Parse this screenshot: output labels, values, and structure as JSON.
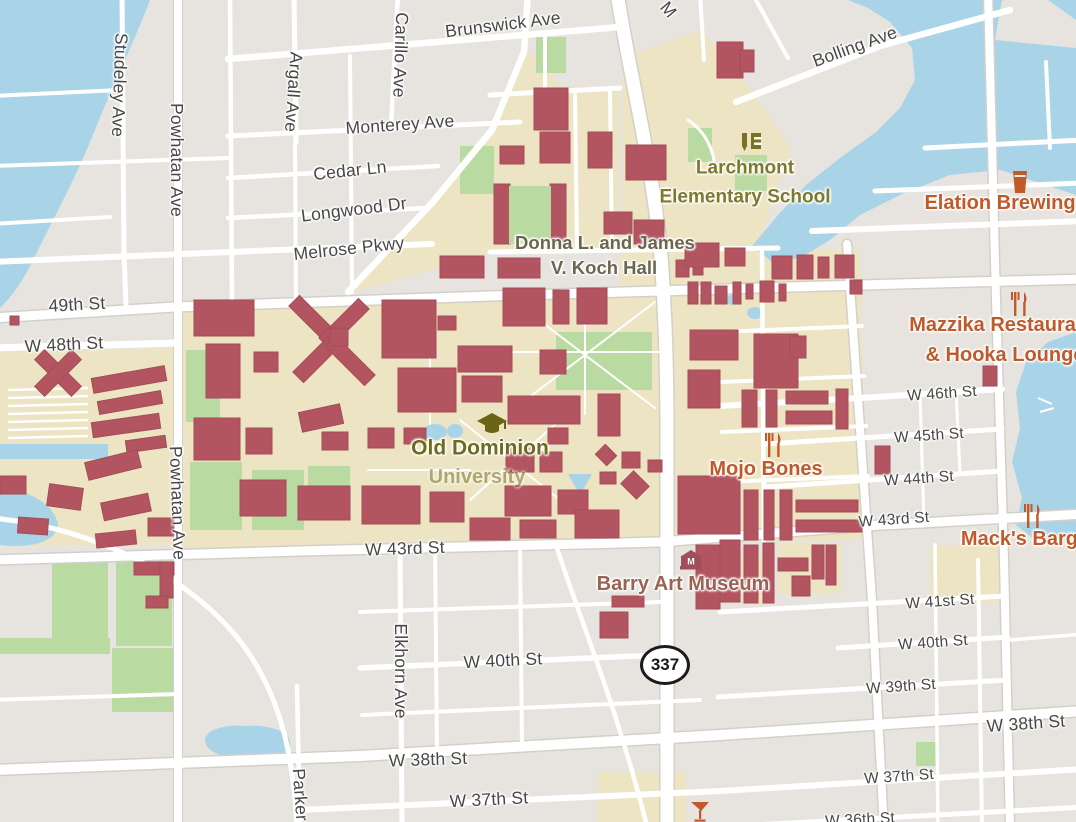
{
  "map": {
    "route_shield": {
      "number": "337"
    },
    "colors": {
      "land": "#e7e4df",
      "water": "#a9d4e8",
      "campus": "#ece4c3",
      "green": "#b9dba2",
      "bld": "#b35561",
      "blds": "#a34c57",
      "road": "#ffffff",
      "casing": "#d4d0c9",
      "street": "#474747",
      "orange": "#c05a2a",
      "olive": "#7c7a2c",
      "campusTxt": "#6f6b1d",
      "kochTxt": "#6b674f",
      "museumTxt": "#9a6254"
    },
    "street_labels": [
      {
        "name": "street-label-brunswick-ave",
        "text": "Brunswick Ave",
        "x": 503,
        "y": 25,
        "r": -7,
        "cls": "lbl-street-major"
      },
      {
        "name": "street-label-bolling-ave",
        "text": "Bolling Ave",
        "x": 855,
        "y": 47,
        "r": -20,
        "cls": "lbl-street-major"
      },
      {
        "name": "street-label-studeley-ave",
        "text": "Studeley Ave",
        "x": 119,
        "y": 85,
        "r": 92,
        "cls": "lbl-street-major"
      },
      {
        "name": "street-label-powhatan-ave-north",
        "text": "Powhatan Ave",
        "x": 176,
        "y": 160,
        "r": 90,
        "cls": "lbl-street-major"
      },
      {
        "name": "street-label-argall-ave",
        "text": "Argall Ave",
        "x": 293,
        "y": 92,
        "r": 94,
        "cls": "lbl-street-major"
      },
      {
        "name": "street-label-carillo-ave",
        "text": "Carillo Ave",
        "x": 400,
        "y": 55,
        "r": 92,
        "cls": "lbl-street-major"
      },
      {
        "name": "street-label-monterey-ave",
        "text": "Monterey Ave",
        "x": 400,
        "y": 125,
        "r": -4,
        "cls": "lbl-street-major"
      },
      {
        "name": "street-label-cedar-ln",
        "text": "Cedar Ln",
        "x": 350,
        "y": 171,
        "r": -6,
        "cls": "lbl-street-major"
      },
      {
        "name": "street-label-longwood-dr",
        "text": "Longwood Dr",
        "x": 354,
        "y": 210,
        "r": -7,
        "cls": "lbl-street-major"
      },
      {
        "name": "street-label-melrose-pkwy",
        "text": "Melrose Pkwy",
        "x": 349,
        "y": 249,
        "r": -6,
        "cls": "lbl-street-major"
      },
      {
        "name": "street-label-fragment-m",
        "text": "M",
        "x": 668,
        "y": 10,
        "r": 50,
        "cls": "lbl-street-major"
      },
      {
        "name": "street-label-49th-st",
        "text": "49th St",
        "x": 77,
        "y": 305,
        "r": -3,
        "cls": "lbl-street-major"
      },
      {
        "name": "street-label-w-48th-st",
        "text": "W 48th St",
        "x": 64,
        "y": 345,
        "r": -3,
        "cls": "lbl-street-major"
      },
      {
        "name": "street-label-powhatan-ave-south",
        "text": "Powhatan Ave",
        "x": 177,
        "y": 503,
        "r": 88,
        "cls": "lbl-street-major"
      },
      {
        "name": "street-label-w-46th-st",
        "text": "W 46th St",
        "x": 942,
        "y": 394,
        "r": -4,
        "cls": "lbl-street"
      },
      {
        "name": "street-label-w-45th-st",
        "text": "W 45th St",
        "x": 929,
        "y": 436,
        "r": -4,
        "cls": "lbl-street"
      },
      {
        "name": "street-label-w-44th-st",
        "text": "W 44th St",
        "x": 919,
        "y": 479,
        "r": -4,
        "cls": "lbl-street"
      },
      {
        "name": "street-label-w-43rd-st-east",
        "text": "W 43rd St",
        "x": 894,
        "y": 520,
        "r": -4,
        "cls": "lbl-street"
      },
      {
        "name": "street-label-w-43rd-st-center",
        "text": "W 43rd St",
        "x": 405,
        "y": 549,
        "r": -2,
        "cls": "lbl-street-major"
      },
      {
        "name": "street-label-w-41st-st",
        "text": "W 41st St",
        "x": 940,
        "y": 602,
        "r": -4,
        "cls": "lbl-street"
      },
      {
        "name": "street-label-w-40th-st-east",
        "text": "W 40th St",
        "x": 933,
        "y": 643,
        "r": -4,
        "cls": "lbl-street"
      },
      {
        "name": "street-label-w-40th-st-center",
        "text": "W 40th St",
        "x": 503,
        "y": 661,
        "r": -3,
        "cls": "lbl-street-major"
      },
      {
        "name": "street-label-w-39th-st",
        "text": "W 39th St",
        "x": 901,
        "y": 687,
        "r": -4,
        "cls": "lbl-street"
      },
      {
        "name": "street-label-w-38th-st-east",
        "text": "W 38th St",
        "x": 1026,
        "y": 724,
        "r": -4,
        "cls": "lbl-street-major"
      },
      {
        "name": "street-label-w-38th-st-center",
        "text": "W 38th St",
        "x": 428,
        "y": 760,
        "r": -2,
        "cls": "lbl-street-major"
      },
      {
        "name": "street-label-w-37th-st-east",
        "text": "W 37th St",
        "x": 899,
        "y": 777,
        "r": -4,
        "cls": "lbl-street"
      },
      {
        "name": "street-label-w-37th-st-center",
        "text": "W 37th St",
        "x": 489,
        "y": 800,
        "r": -3,
        "cls": "lbl-street-major"
      },
      {
        "name": "street-label-w-36th-st",
        "text": "W 36th St",
        "x": 860,
        "y": 820,
        "r": -3,
        "cls": "lbl-street"
      },
      {
        "name": "street-label-elkhorn-ave",
        "text": "Elkhorn Ave",
        "x": 400,
        "y": 671,
        "r": 90,
        "cls": "lbl-street-major"
      },
      {
        "name": "street-label-parker-ave",
        "text": "Parker Ave",
        "x": 301,
        "y": 812,
        "r": 86,
        "cls": "lbl-street-major"
      }
    ],
    "poi_labels": [
      {
        "name": "poi-label-larchmont-line1",
        "text": "Larchmont",
        "x": 745,
        "y": 168,
        "cls": "lbl-poi-olive"
      },
      {
        "name": "poi-label-larchmont-line2",
        "text": "Elementary School",
        "x": 745,
        "y": 197,
        "cls": "lbl-poi-olive"
      },
      {
        "name": "poi-label-elation-brewing",
        "text": "Elation Brewing",
        "x": 1000,
        "y": 203,
        "cls": "lbl-poi-orange"
      },
      {
        "name": "poi-label-mazzika-line1",
        "text": "Mazzika Restaurant",
        "x": 1002,
        "y": 325,
        "cls": "lbl-poi-orange"
      },
      {
        "name": "poi-label-mazzika-line2",
        "text": "& Hooka Lounge",
        "x": 1005,
        "y": 355,
        "cls": "lbl-poi-orange"
      },
      {
        "name": "poi-label-mojo-bones",
        "text": "Mojo Bones",
        "x": 766,
        "y": 469,
        "cls": "lbl-poi-orange"
      },
      {
        "name": "poi-label-macks-barge",
        "text": "Mack's Barge",
        "x": 1025,
        "y": 539,
        "cls": "lbl-poi-orange"
      },
      {
        "name": "poi-label-koch-hall-line1",
        "text": "Donna L. and James",
        "x": 605,
        "y": 243,
        "cls": "lbl-koch"
      },
      {
        "name": "poi-label-koch-hall-line2",
        "text": "V. Koch Hall",
        "x": 604,
        "y": 268,
        "cls": "lbl-koch"
      },
      {
        "name": "poi-label-odu-line1",
        "text": "Old Dominion",
        "x": 480,
        "y": 448,
        "cls": "lbl-campus"
      },
      {
        "name": "poi-label-odu-line2",
        "text": "University",
        "x": 477,
        "y": 477,
        "cls": "lbl-campus-faded"
      },
      {
        "name": "poi-label-barry-art-museum",
        "text": "Barry Art Museum",
        "x": 683,
        "y": 584,
        "cls": "lbl-museum"
      }
    ],
    "icons": [
      {
        "type": "graduation-cap",
        "x": 477,
        "y": 413
      },
      {
        "type": "school",
        "x": 742,
        "y": 133
      },
      {
        "type": "beer",
        "x": 1012,
        "y": 171
      },
      {
        "type": "restaurant",
        "x": 1011,
        "y": 292
      },
      {
        "type": "restaurant",
        "x": 765,
        "y": 433
      },
      {
        "type": "restaurant",
        "x": 1024,
        "y": 504
      },
      {
        "type": "bar",
        "x": 691,
        "y": 802
      },
      {
        "type": "museum",
        "x": 680,
        "y": 550
      }
    ]
  }
}
